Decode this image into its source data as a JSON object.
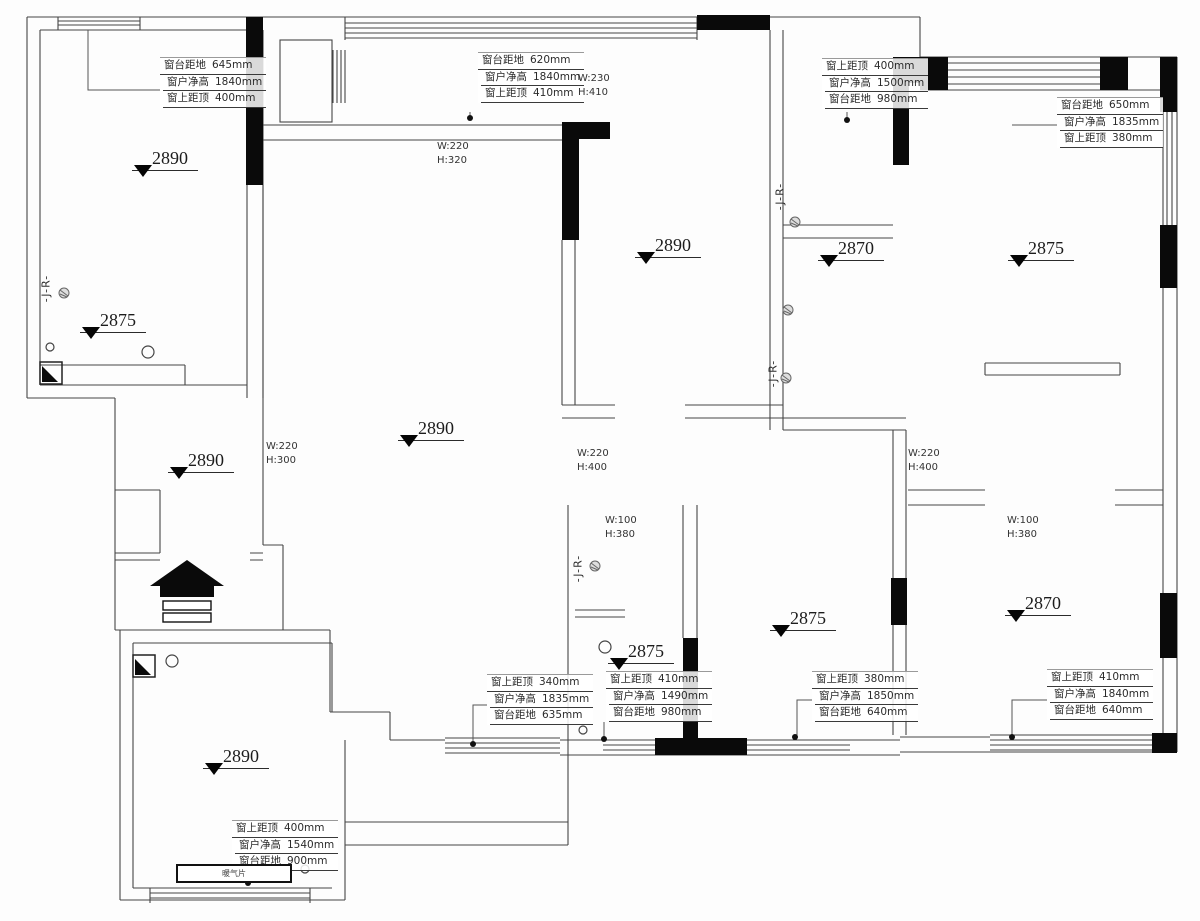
{
  "symbols": {
    "jr_text": "-J-R-"
  },
  "fixtures": {
    "radiator_label": "暖气片"
  },
  "elevations": [
    {
      "value": "2890"
    },
    {
      "value": "2875"
    },
    {
      "value": "2890"
    },
    {
      "value": "2890"
    },
    {
      "value": "2890"
    },
    {
      "value": "2870"
    },
    {
      "value": "2875"
    },
    {
      "value": "2875"
    },
    {
      "value": "2875"
    },
    {
      "value": "2870"
    },
    {
      "value": "2890"
    }
  ],
  "beams": [
    {
      "w": "W:220",
      "h": "H:320"
    },
    {
      "w": "W:230",
      "h": "H:410"
    },
    {
      "w": "W:220",
      "h": "H:300"
    },
    {
      "w": "W:220",
      "h": "H:400"
    },
    {
      "w": "W:220",
      "h": "H:400"
    },
    {
      "w": "W:100",
      "h": "H:380"
    },
    {
      "w": "W:100",
      "h": "H:380"
    }
  ],
  "window_blocks": {
    "b1": {
      "rows": [
        {
          "label": "窗台距地",
          "value": "645mm"
        },
        {
          "label": "窗户净高",
          "value": "1840mm"
        },
        {
          "label": "窗上距顶",
          "value": "400mm"
        }
      ]
    },
    "b2": {
      "rows": [
        {
          "label": "窗台距地",
          "value": "620mm"
        },
        {
          "label": "窗户净高",
          "value": "1840mm"
        },
        {
          "label": "窗上距顶",
          "value": "410mm"
        }
      ]
    },
    "b3": {
      "rows": [
        {
          "label": "窗上距顶",
          "value": "400mm"
        },
        {
          "label": "窗户净高",
          "value": "1500mm"
        },
        {
          "label": "窗台距地",
          "value": "980mm"
        }
      ]
    },
    "b4": {
      "rows": [
        {
          "label": "窗台距地",
          "value": "650mm"
        },
        {
          "label": "窗户净高",
          "value": "1835mm"
        },
        {
          "label": "窗上距顶",
          "value": "380mm"
        }
      ]
    },
    "b5": {
      "rows": [
        {
          "label": "窗上距顶",
          "value": "340mm"
        },
        {
          "label": "窗户净高",
          "value": "1835mm"
        },
        {
          "label": "窗台距地",
          "value": "635mm"
        }
      ]
    },
    "b6": {
      "rows": [
        {
          "label": "窗上距顶",
          "value": "410mm"
        },
        {
          "label": "窗户净高",
          "value": "1490mm"
        },
        {
          "label": "窗台距地",
          "value": "980mm"
        }
      ]
    },
    "b7": {
      "rows": [
        {
          "label": "窗上距顶",
          "value": "380mm"
        },
        {
          "label": "窗户净高",
          "value": "1850mm"
        },
        {
          "label": "窗台距地",
          "value": "640mm"
        }
      ]
    },
    "b8": {
      "rows": [
        {
          "label": "窗上距顶",
          "value": "410mm"
        },
        {
          "label": "窗户净高",
          "value": "1840mm"
        },
        {
          "label": "窗台距地",
          "value": "640mm"
        }
      ]
    },
    "b9": {
      "rows": [
        {
          "label": "窗上距顶",
          "value": "400mm"
        },
        {
          "label": "窗户净高",
          "value": "1540mm"
        },
        {
          "label": "窗台距地",
          "value": "900mm"
        }
      ]
    }
  }
}
